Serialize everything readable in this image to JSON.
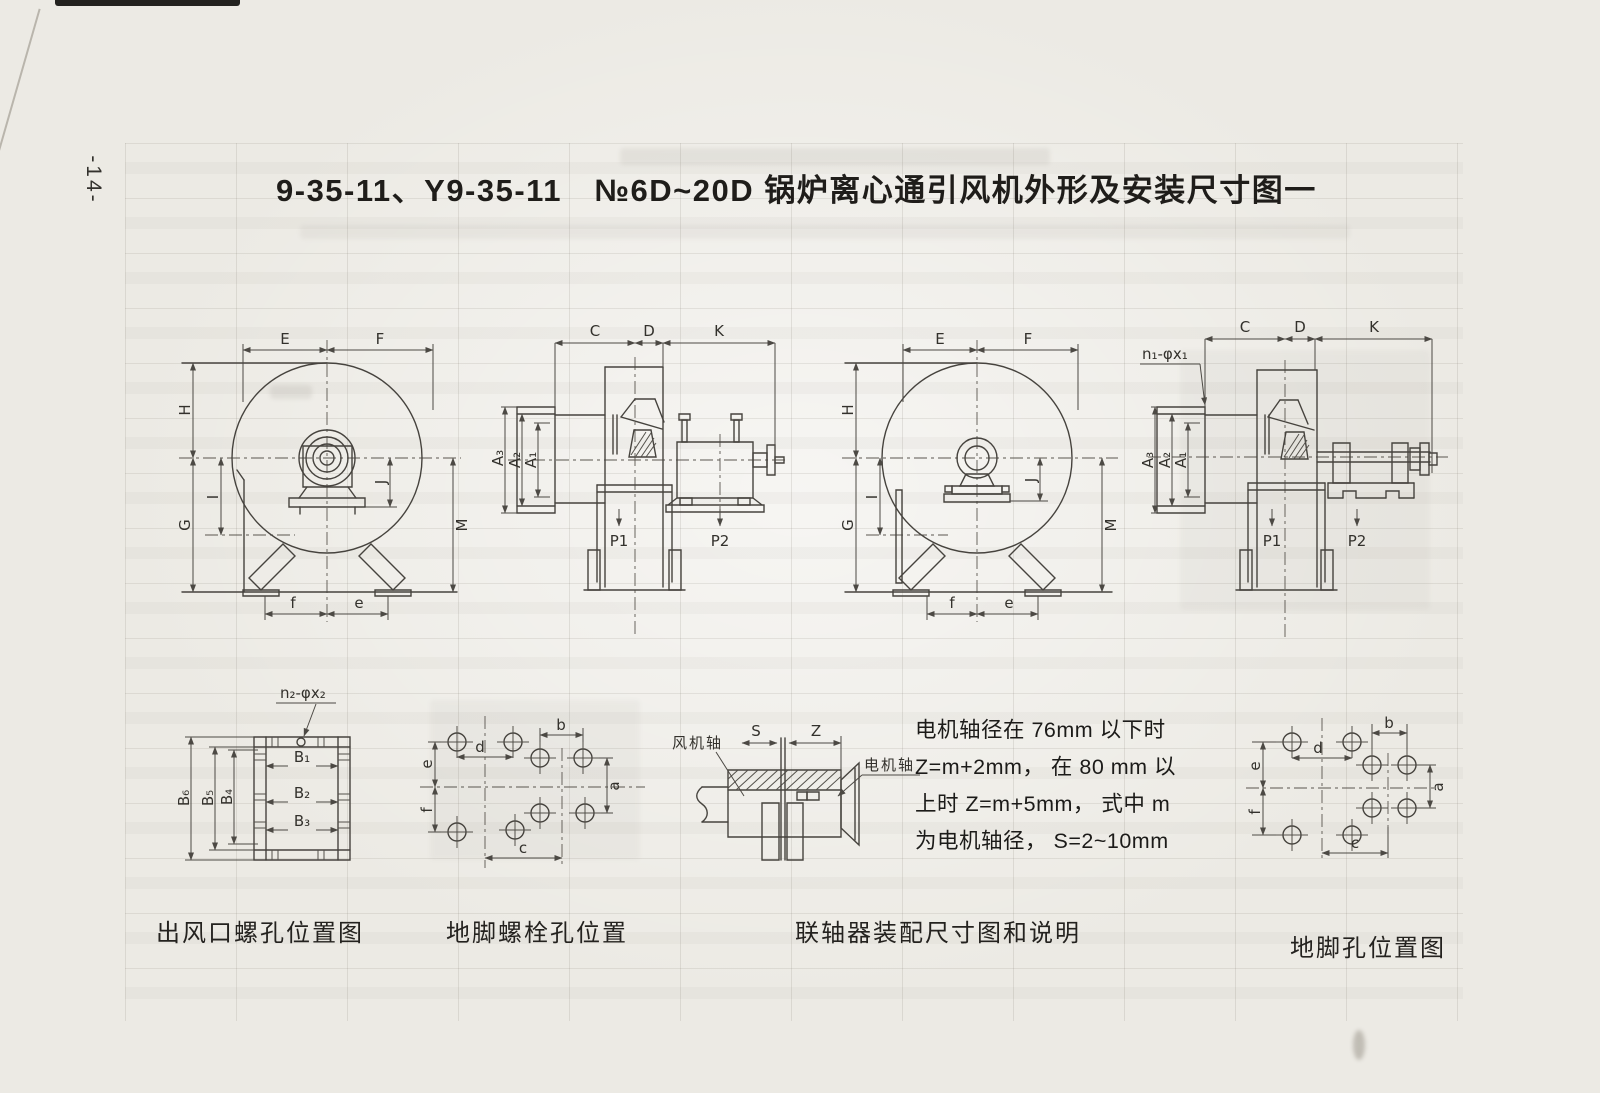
{
  "page": {
    "number": "-14-",
    "title": "9-35-11、Y9-35-11　№6D~20D 锅炉离心通引风机外形及安装尺寸图一"
  },
  "fan_view": {
    "dims": {
      "E": "E",
      "F": "F",
      "H": "H",
      "I": "I",
      "G": "G",
      "J": "J",
      "M": "M",
      "f": "f",
      "e": "e"
    }
  },
  "section_view": {
    "dims": {
      "C": "C",
      "D": "D",
      "K": "K",
      "A3": "A₃",
      "A2": "A₂",
      "A1": "A₁",
      "P1": "P1",
      "P2": "P2"
    },
    "inlet_holes": "n₁-φx₁"
  },
  "outlet_flange": {
    "holes": "n₂-φx₂",
    "dims": {
      "B1": "B₁",
      "B2": "B₂",
      "B3": "B₃",
      "B4": "B₄",
      "B5": "B₅",
      "B6": "B₆"
    }
  },
  "bolt_layout": {
    "dims": {
      "a": "a",
      "b": "b",
      "c": "c",
      "d": "d",
      "e": "e",
      "f": "f"
    }
  },
  "coupling": {
    "fan_shaft_label": "风机轴",
    "motor_shaft_label": "电机轴",
    "dims": {
      "S": "S",
      "Z": "Z"
    }
  },
  "note": {
    "line1": "电机轴径在 76mm 以下时",
    "line2": "Z=m+2mm， 在 80 mm 以",
    "line3": "上时 Z=m+5mm， 式中 m",
    "line4": "为电机轴径， S=2~10mm"
  },
  "captions": {
    "outlet_flange": "出风口螺孔位置图",
    "foundation_bolt": "地脚螺栓孔位置",
    "coupling": "联轴器装配尺寸图和说明",
    "foundation_hole": "地脚孔位置图"
  }
}
